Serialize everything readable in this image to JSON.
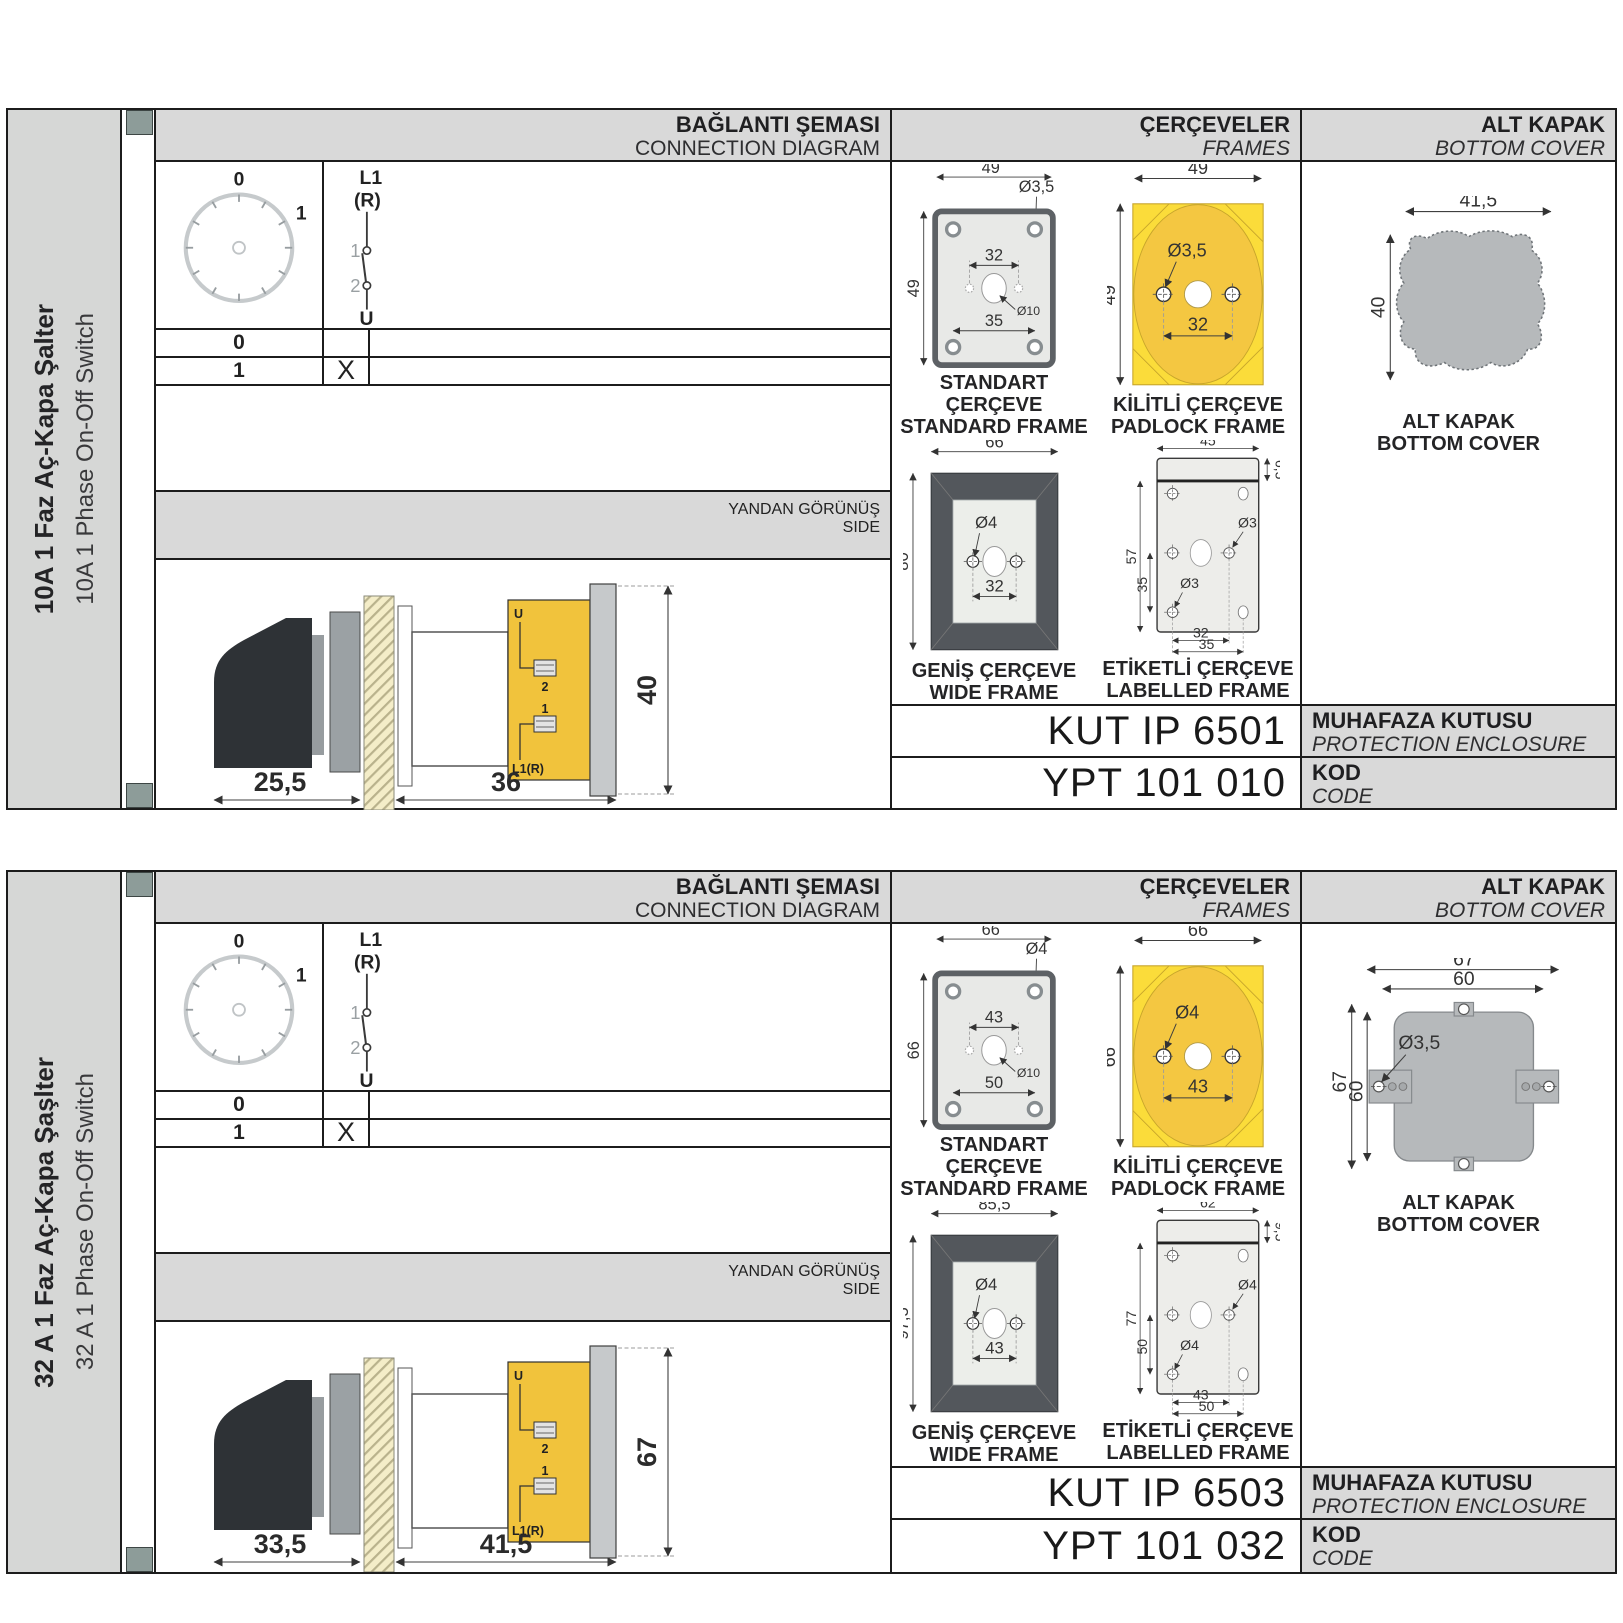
{
  "colors": {
    "band_gray": "#d9d9d9",
    "sidebar_gray": "#d6d7d6",
    "slate_square": "#8d9c99",
    "frame_yellow": "#FBDC3A",
    "frame_yellow_circle": "#F4C741",
    "terminal_yellow": "#F1C33C",
    "dark_frame": "#53575c",
    "cover_gray": "#b6b9bb"
  },
  "sections": [
    {
      "sidebar": {
        "title_tr": "10A 1 Faz Aç-Kapa Şalter",
        "title_en": "10A 1 Phase On-Off Switch"
      },
      "connection": {
        "title_tr": "BAĞLANTI ŞEMASI",
        "title_en": "CONNECTION DIAGRAM",
        "dial": {
          "pos0": "0",
          "pos1": "1"
        },
        "symbol": {
          "top": "L1",
          "top2": "(R)",
          "c1": "1",
          "c2": "2",
          "bottom": "U"
        },
        "table": {
          "rows": [
            {
              "position": "0",
              "contact": ""
            },
            {
              "position": "1",
              "contact": "X"
            }
          ]
        }
      },
      "side_view": {
        "title_tr": "YANDAN GÖRÜNÜŞ",
        "title_en": "SIDE",
        "dim_front": "25,5",
        "dim_back": "36",
        "dim_height": "40",
        "label_u": "U",
        "label_t2": "2",
        "label_t1": "1",
        "label_l1r": "L1(R)"
      },
      "frames": {
        "title_tr": "ÇERÇEVELER",
        "title_en": "FRAMES",
        "standard": {
          "caption_tr": "STANDART ÇERÇEVE",
          "caption_en": "STANDARD FRAME",
          "dim_width": "49",
          "dim_height": "49",
          "dim_hole": "Ø3,5",
          "dim_inner": "32",
          "dim_center": "Ø10",
          "dim_lower": "35"
        },
        "padlock": {
          "caption_tr": "KİLİTLİ ÇERÇEVE",
          "caption_en": "PADLOCK FRAME",
          "dim_width": "49",
          "dim_height": "49",
          "dim_hole": "Ø3,5",
          "dim_span": "32"
        },
        "wide": {
          "caption_tr": "GENİŞ ÇERÇEVE",
          "caption_en": "WIDE FRAME",
          "dim_width": "66",
          "dim_height": "80",
          "dim_hole": "Ø4",
          "dim_span": "32"
        },
        "labelled": {
          "caption_tr": "ETİKETLİ ÇERÇEVE",
          "caption_en": "LABELLED FRAME",
          "dim_width": "45",
          "dim_label": "6,5",
          "dim_height": "57",
          "dim_inner": "35",
          "dim_hole1": "Ø3",
          "dim_hole2": "Ø3",
          "dim_span1": "32",
          "dim_span2": "35"
        }
      },
      "cover": {
        "title_tr": "ALT KAPAK",
        "title_en": "BOTTOM COVER",
        "caption_tr": "ALT KAPAK",
        "caption_en": "BOTTOM COVER",
        "dim_width": "41,5",
        "dim_height": "40"
      },
      "codes": {
        "enclosure_value": "KUT IP 6501",
        "enclosure_tr": "MUHAFAZA KUTUSU",
        "enclosure_en": "PROTECTION ENCLOSURE",
        "code_value": "YPT 101 010",
        "code_tr": "KOD",
        "code_en": "CODE"
      }
    },
    {
      "sidebar": {
        "title_tr": "32 A 1 Faz Aç-Kapa Şaşlter",
        "title_en": "32 A 1 Phase On-Off Switch"
      },
      "connection": {
        "title_tr": "BAĞLANTI ŞEMASI",
        "title_en": "CONNECTION DIAGRAM",
        "dial": {
          "pos0": "0",
          "pos1": "1"
        },
        "symbol": {
          "top": "L1",
          "top2": "(R)",
          "c1": "1",
          "c2": "2",
          "bottom": "U"
        },
        "table": {
          "rows": [
            {
              "position": "0",
              "contact": ""
            },
            {
              "position": "1",
              "contact": "X"
            }
          ]
        }
      },
      "side_view": {
        "title_tr": "YANDAN GÖRÜNÜŞ",
        "title_en": "SIDE",
        "dim_front": "33,5",
        "dim_back": "41,5",
        "dim_height": "67",
        "label_u": "U",
        "label_t2": "2",
        "label_t1": "1",
        "label_l1r": "L1(R)"
      },
      "frames": {
        "title_tr": "ÇERÇEVELER",
        "title_en": "FRAMES",
        "standard": {
          "caption_tr": "STANDART ÇERÇEVE",
          "caption_en": "STANDARD FRAME",
          "dim_width": "66",
          "dim_height": "66",
          "dim_hole": "Ø4",
          "dim_inner": "43",
          "dim_center": "Ø10",
          "dim_lower": "50"
        },
        "padlock": {
          "caption_tr": "KİLİTLİ ÇERÇEVE",
          "caption_en": "PADLOCK FRAME",
          "dim_width": "66",
          "dim_height": "66",
          "dim_hole": "Ø4",
          "dim_span": "43"
        },
        "wide": {
          "caption_tr": "GENİŞ ÇERÇEVE",
          "caption_en": "WIDE FRAME",
          "dim_width": "85,5",
          "dim_height": "97,5",
          "dim_hole": "Ø4",
          "dim_span": "43"
        },
        "labelled": {
          "caption_tr": "ETİKETLİ ÇERÇEVE",
          "caption_en": "LABELLED FRAME",
          "dim_width": "62",
          "dim_label": "9,5",
          "dim_height": "77",
          "dim_inner": "50",
          "dim_hole1": "Ø4",
          "dim_hole2": "Ø4",
          "dim_span1": "43",
          "dim_span2": "50"
        }
      },
      "cover": {
        "title_tr": "ALT KAPAK",
        "title_en": "BOTTOM COVER",
        "caption_tr": "ALT KAPAK",
        "caption_en": "BOTTOM COVER",
        "dim_w_outer": "67",
        "dim_w_inner": "60",
        "dim_hole": "Ø3,5",
        "dim_h_outer": "67",
        "dim_h_inner": "60"
      },
      "codes": {
        "enclosure_value": "KUT IP 6503",
        "enclosure_tr": "MUHAFAZA KUTUSU",
        "enclosure_en": "PROTECTION ENCLOSURE",
        "code_value": "YPT 101 032",
        "code_tr": "KOD",
        "code_en": "CODE"
      }
    }
  ]
}
